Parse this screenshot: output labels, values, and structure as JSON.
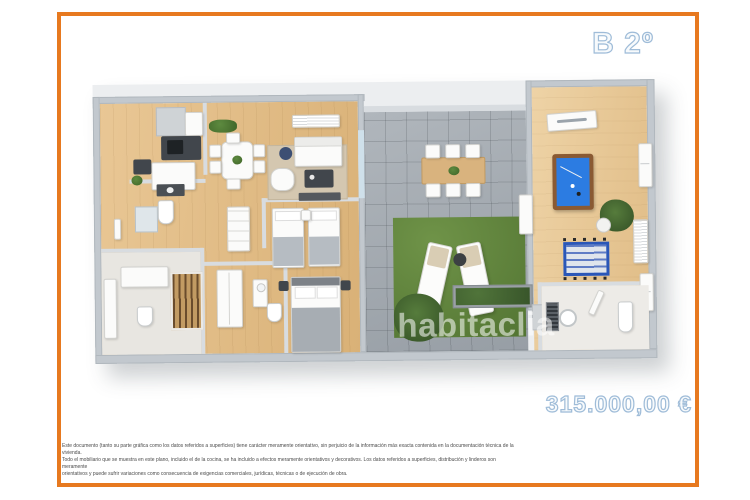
{
  "frame": {
    "border_color": "#E7791F",
    "background": "#ffffff"
  },
  "unit_label": {
    "text": "B 2º"
  },
  "price": {
    "text": "315.000,00 €"
  },
  "watermark": {
    "text": "habitaclia"
  },
  "label_style": {
    "fill": "#f7fafc",
    "outline": "#9fbcd8"
  },
  "disclaimer": {
    "lines": [
      "Este documento (tanto su parte gráfica como los datos referidos a superficies) tiene carácter meramente orientativo, sin perjuicio de la información más exacta contenida en la documentación técnica de la vivienda.",
      "Todo el mobiliario que se muestra en este plano, incluido el de la cocina, se ha incluido a efectos meramente orientativos y decorativos. Los datos referidos a superficies, distribución y linderos son meramente",
      "orientativos y puede sufrir variaciones como consecuencia de exigencias comerciales, jurídicas, técnicas o de ejecución de obra."
    ]
  },
  "floor_plan": {
    "colors": {
      "wood_floor": "#e0bb84",
      "games_room_floor": "#e6c996",
      "terrace_tile": "#a4abb1",
      "grass": "#5d8040",
      "wall": "#c2c8ce",
      "billiard_felt": "#2c7ce2",
      "billiard_frame": "#8a5a33",
      "foosball_blue": "#2a57b8",
      "rug": "#d4c7b0",
      "bed_blanket": "#a7adb3"
    }
  }
}
